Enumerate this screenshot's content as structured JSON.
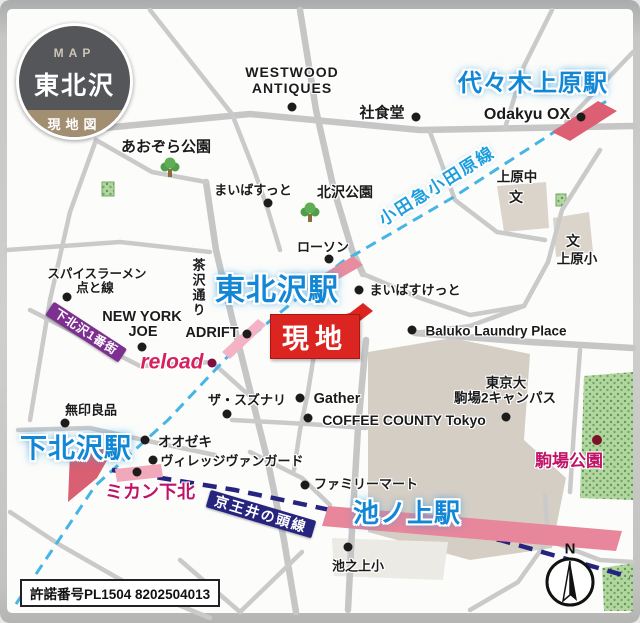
{
  "badge": {
    "kicker": "MAP",
    "title": "東北沢",
    "subtitle": "現地図"
  },
  "site_marker": {
    "label": "現地"
  },
  "stations": {
    "yoyogi_uehara": "代々木上原駅",
    "higashi_kitazawa": "東北沢駅",
    "shimokitazawa": "下北沢駅",
    "ikenoue": "池ノ上駅"
  },
  "rail_lines": {
    "odakyu": "小田急小田原線",
    "keio": "京王井の頭線"
  },
  "streets": {
    "chazawa": "茶沢通り",
    "ichibangai": "下北沢1番街"
  },
  "parks": {
    "aozora": "あおぞら公園",
    "kitazawa": "北沢公園",
    "komaba": "駒場公園"
  },
  "schools": {
    "symbol": "文",
    "uehara_jhs": "上原中",
    "uehara_es": "上原小",
    "ikenoue_es": "池之上小",
    "univ_line1": "東京大",
    "univ_line2": "駒場2キャンパス"
  },
  "pois": {
    "westwood_line1": "WESTWOOD",
    "westwood_line2": "ANTIQUES",
    "shashokudo": "社食堂",
    "odakyu_ox": "Odakyu OX",
    "maibasutto": "まいばすっと",
    "lawson": "ローソン",
    "maibasketto": "まいばすけっと",
    "baluko": "Baluko Laundry Place",
    "spice_line1": "スパイスラーメン",
    "spice_line2": "点と線",
    "ny_line1": "NEW YORK",
    "ny_line2": "JOE",
    "adrift": "ADRIFT",
    "reload": "reload",
    "mujirushi": "無印良品",
    "suzunari": "ザ・スズナリ",
    "gather": "Gather",
    "coffee_county": "COFFEE COUNTY Tokyo",
    "oozeki": "オオゼキ",
    "village_vanguard": "ヴィレッジヴァンガード",
    "mikan": "ミカン下北",
    "familymart": "ファミリーマート"
  },
  "compass": {
    "north": "N"
  },
  "footer": {
    "license": "許諾番号PL1504 8202504013"
  },
  "colors": {
    "station_blue": "#1287d5",
    "site_red": "#dc2521",
    "odakyu_line_blue": "#45b4e6",
    "keio_line_navy": "#26247e",
    "station_pink": "#dd5f74",
    "magenta": "#c01368",
    "banner_purple": "#7d3091",
    "road_gray": "#c6c6c6",
    "campus_beige": "#d5cec5",
    "park_green": "#9ec98f",
    "badge_gray": "#54565a",
    "badge_tan": "#a28e71"
  }
}
